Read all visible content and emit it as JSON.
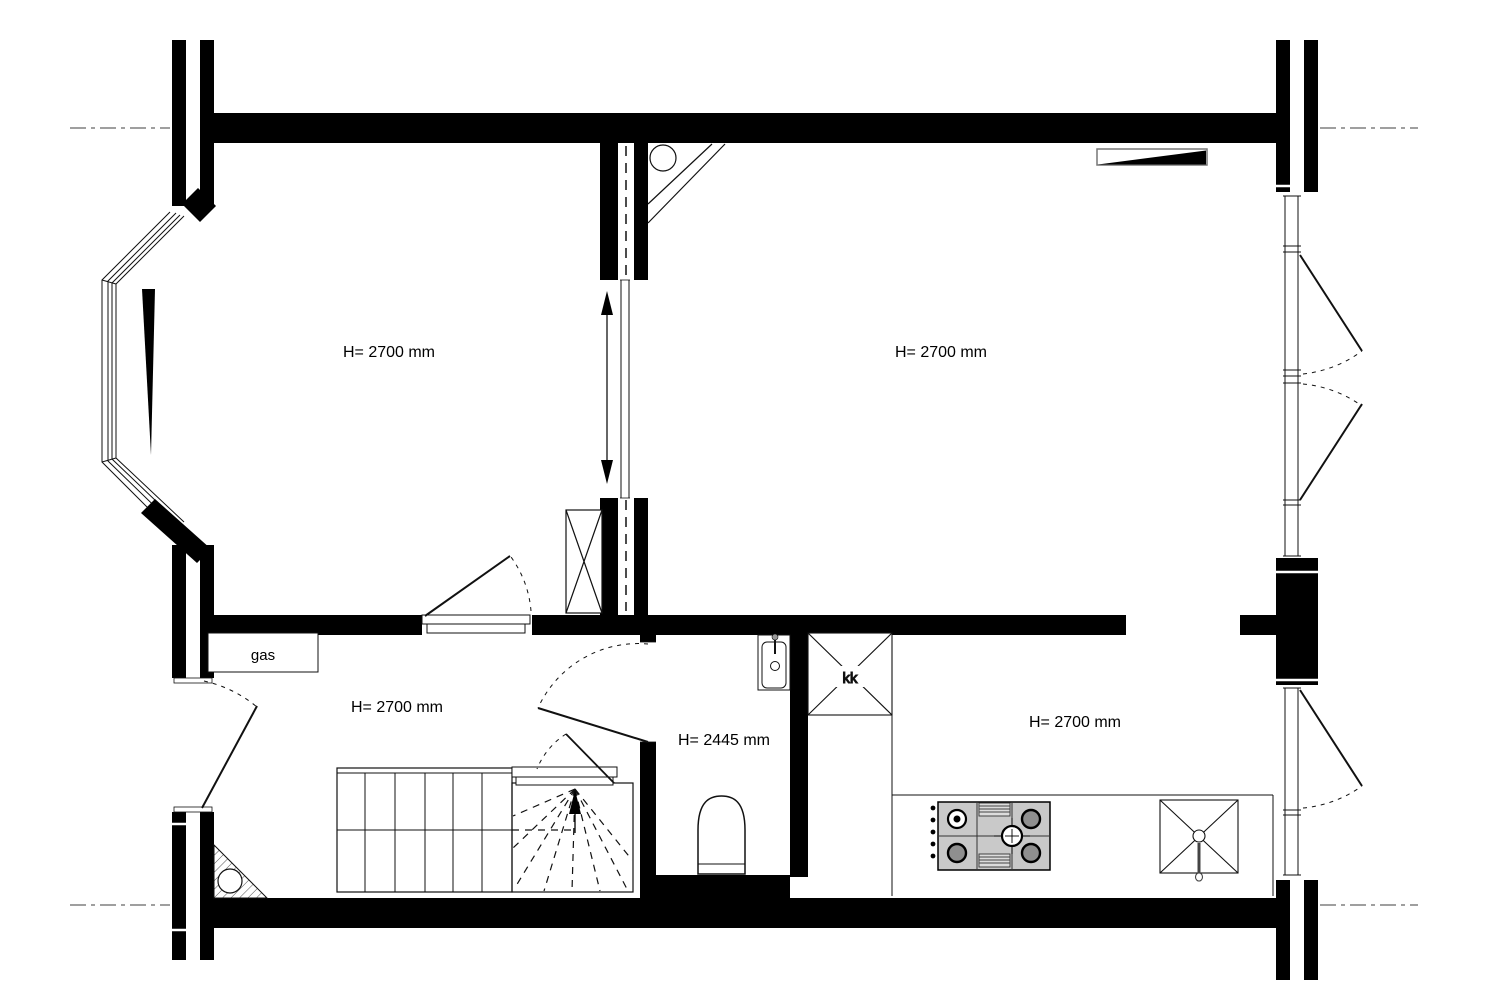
{
  "drawing": {
    "type": "architectural-floor-plan",
    "rooms": [
      {
        "id": "living-room-front",
        "height_label": "H= 2700 mm"
      },
      {
        "id": "living-room-back",
        "height_label": "H= 2700 mm"
      },
      {
        "id": "hallway",
        "height_label": "H= 2700 mm"
      },
      {
        "id": "toilet",
        "height_label": "H= 2445 mm"
      },
      {
        "id": "kitchen",
        "height_label": "H= 2700 mm"
      }
    ],
    "annotations": {
      "gas_meter_label": "gas",
      "fridge_label": "kk"
    },
    "symbols": [
      "bay-window",
      "sliding-door",
      "double-arrow",
      "stair-up-arrow",
      "door-swing-arc",
      "radiator",
      "shaft-cross-box",
      "gas-hob",
      "kitchen-sink",
      "washbasin",
      "toilet-bowl",
      "hatched-meter-corner",
      "centerline"
    ],
    "colors": {
      "wall": "#000000",
      "background": "#ffffff",
      "line": "#1a1a1a",
      "stove_body": "#c9c9c9",
      "burner_fill": "#8f8f8f",
      "centerline": "#666666"
    }
  }
}
